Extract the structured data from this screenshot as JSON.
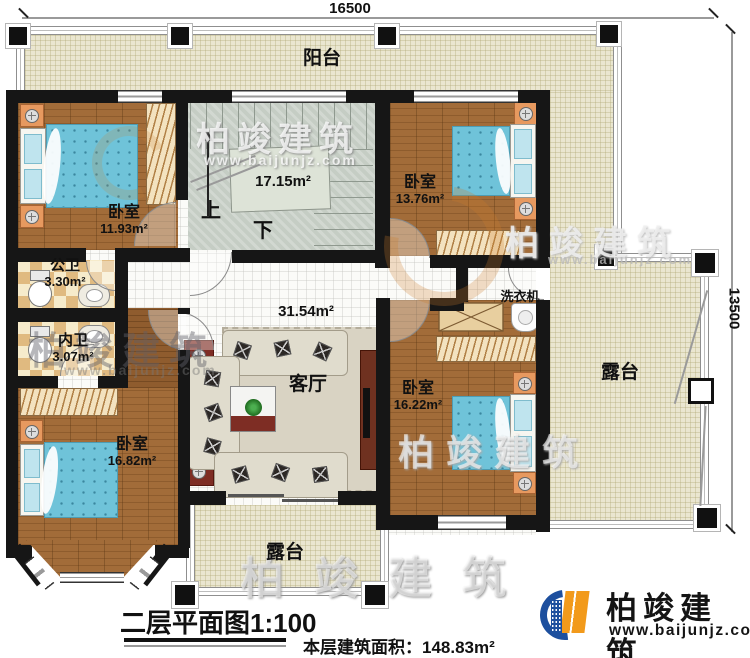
{
  "dimensions": {
    "top": "16500",
    "right": "13500"
  },
  "rooms": {
    "balcony_top": {
      "name": "阳台"
    },
    "bedroom_top_left": {
      "name": "卧室",
      "area": "11.93m²"
    },
    "bedroom_top_right": {
      "name": "卧室",
      "area": "13.76m²"
    },
    "bedroom_bottom_left": {
      "name": "卧室",
      "area": "16.82m²"
    },
    "bedroom_bottom_right": {
      "name": "卧室",
      "area": "16.22m²"
    },
    "bath_public": {
      "name": "公卫",
      "area": "3.30m²"
    },
    "bath_ensuite": {
      "name": "内卫",
      "area": "3.07m²"
    },
    "stairwell": {
      "area": "17.15m²",
      "up": "上",
      "down": "下"
    },
    "living_room": {
      "name": "客厅",
      "area": "31.54m²"
    },
    "laundry": {
      "name": "洗衣机"
    },
    "terrace_right": {
      "name": "露台"
    },
    "terrace_bottom": {
      "name": "露台"
    }
  },
  "footer": {
    "plan_title": "二层平面图1:100",
    "area_label": "本层建筑面积：",
    "area_value": "148.83m²"
  },
  "branding": {
    "company": "柏竣建筑",
    "website": "www.baijunjz.com"
  },
  "watermark": {
    "text": "柏竣建筑",
    "url": "www.baijunjz.com"
  },
  "colors": {
    "wall": "#161616",
    "wood": "#a26c39",
    "terrace": "#eae6d0",
    "bed": "#6fc3d9",
    "stair": "#c5cdc4",
    "logo_blue": "#1d4f9e",
    "logo_orange": "#f29a1b"
  }
}
